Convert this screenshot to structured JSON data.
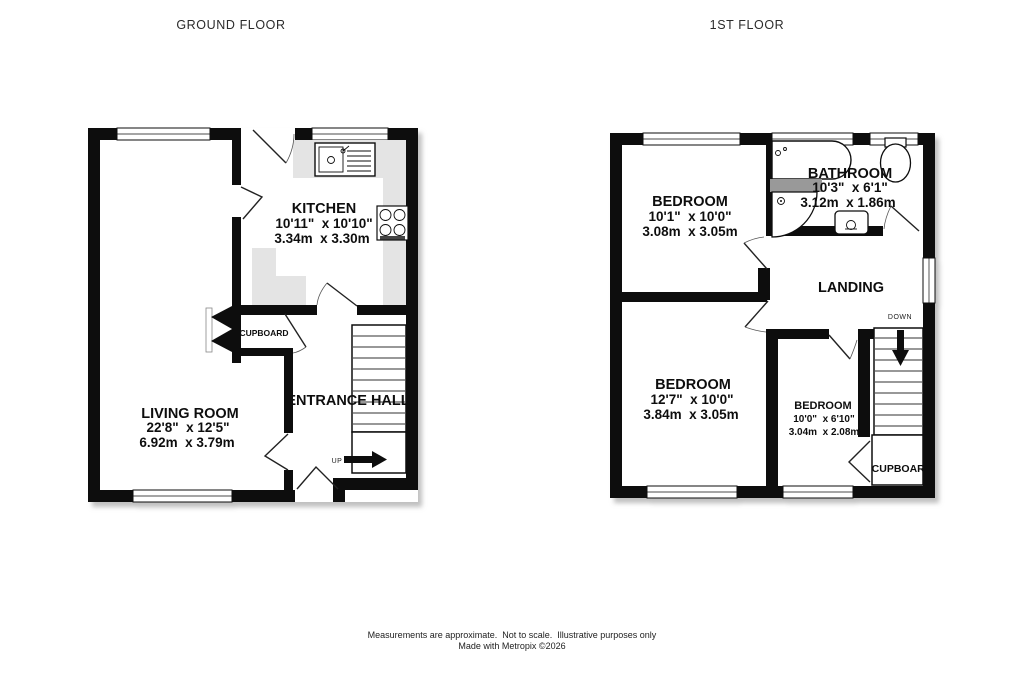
{
  "titles": {
    "ground_floor": "GROUND FLOOR",
    "first_floor": "1ST FLOOR"
  },
  "ground_floor": {
    "kitchen": {
      "name": "KITCHEN",
      "imperial": "10'11\"  x 10'10\"",
      "metric": "3.34m  x 3.30m"
    },
    "living_room": {
      "name": "LIVING ROOM",
      "imperial": "22'8\"  x 12'5\"",
      "metric": "6.92m  x 3.79m"
    },
    "cupboard": {
      "name": "CUPBOARD"
    },
    "entrance_hall": {
      "name": "ENTRANCE HALL"
    },
    "stairs": {
      "direction_label": "UP"
    }
  },
  "first_floor": {
    "bedroom_top": {
      "name": "BEDROOM",
      "imperial": "10'1\"  x 10'0\"",
      "metric": "3.08m  x 3.05m"
    },
    "bathroom": {
      "name": "BATHROOM",
      "imperial": "10'3\"  x 6'1\"",
      "metric": "3.12m  x 1.86m"
    },
    "landing": {
      "name": "LANDING"
    },
    "bedroom_left": {
      "name": "BEDROOM",
      "imperial": "12'7\"  x 10'0\"",
      "metric": "3.84m  x 3.05m"
    },
    "bedroom_small": {
      "name": "BEDROOM",
      "imperial": "10'0\"  x 6'10\"",
      "metric": "3.04m  x 2.08m"
    },
    "cupboard": {
      "name": "CUPBOARD"
    },
    "stairs": {
      "direction_label": "DOWN"
    }
  },
  "footer": {
    "line1": "Measurements are approximate.  Not to scale.  Illustrative purposes only",
    "line2": "Made with Metropix ©2026"
  },
  "colors": {
    "wall": "#111111",
    "counter": "#e4e4e4",
    "fixture_gray": "#999999",
    "shadow": "#b5b5b5",
    "text": "#111111"
  }
}
